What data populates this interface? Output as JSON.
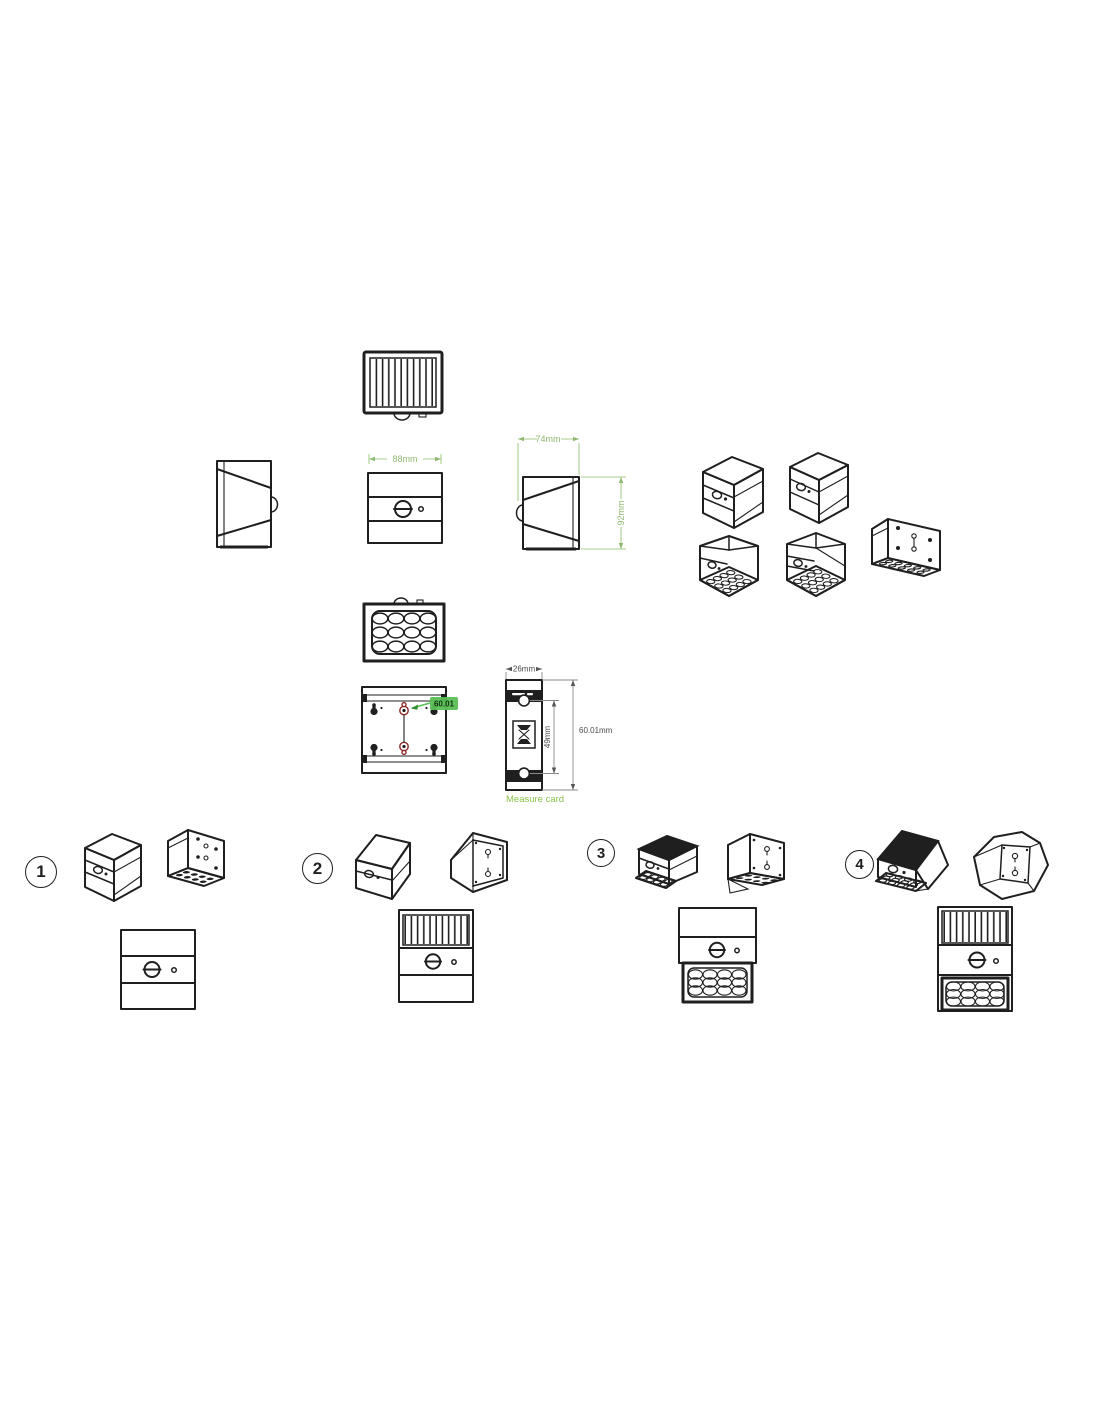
{
  "diagram": {
    "dims": {
      "front_width": "88mm",
      "side_depth": "74mm",
      "side_height": "92mm",
      "card_width": "26mm",
      "card_hole_spacing": "49mm",
      "card_length": "60.01mm"
    },
    "annotations": {
      "back_hole_spacing": "60.01",
      "card_caption": "Measure card"
    },
    "models": [
      {
        "number": "1"
      },
      {
        "number": "2"
      },
      {
        "number": "3"
      },
      {
        "number": "4"
      }
    ],
    "colors": {
      "ink": "#1f1f1f",
      "dimension_green": "#95bd78",
      "caption_green": "#8bc34a",
      "annotation_green": "#58bf55",
      "keyhole_red": "#8b2a2a"
    }
  }
}
